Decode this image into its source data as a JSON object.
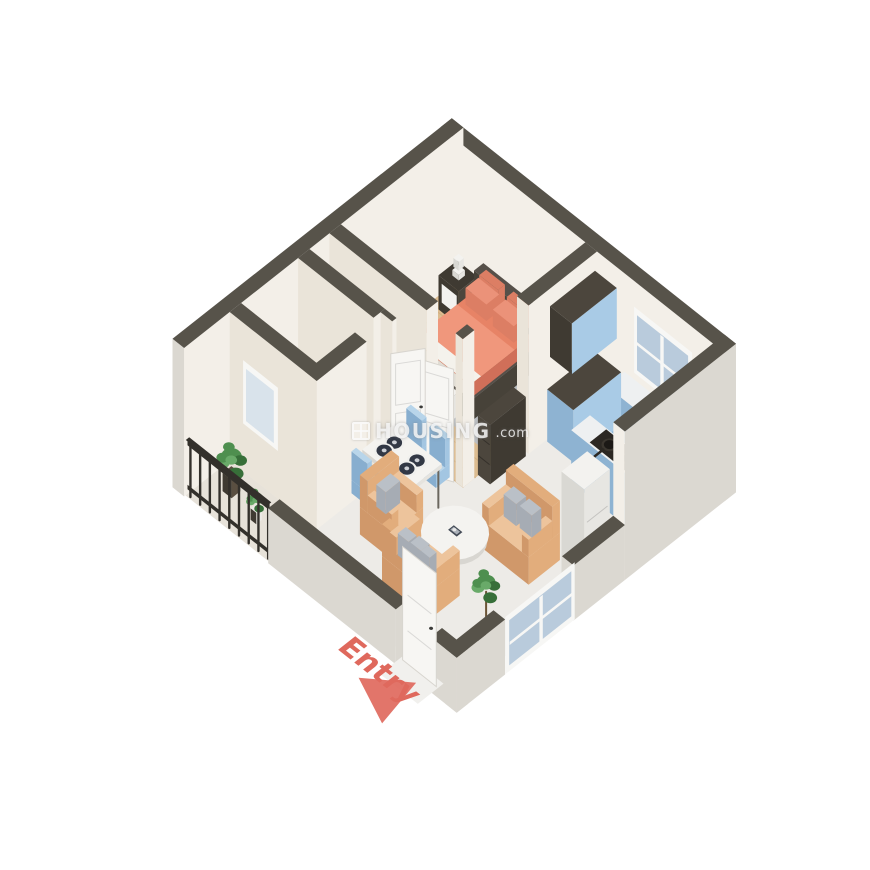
{
  "watermark": {
    "brand": "HOUSING",
    "tld": ".com",
    "logo": "housing-grid-logo",
    "opacity": 0.82
  },
  "labels": {
    "entry": "Entry"
  },
  "scene": {
    "type": "isometric-3d-floorplan",
    "rooms": [
      "bedroom",
      "bathroom",
      "balcony",
      "kitchen",
      "living-dining"
    ],
    "furniture": [
      "double-bed",
      "nightstand",
      "table-lamp",
      "bed-bench",
      "tv-console",
      "wardrobe-dresser",
      "toilet",
      "washbasin",
      "dining-table",
      "dining-chairs",
      "dinner-plates",
      "armchair",
      "loveseat",
      "sofa",
      "coffee-table",
      "kitchen-counter",
      "kitchen-island",
      "stove-with-pots",
      "tall-cabinet",
      "refrigerator",
      "windows",
      "doors",
      "balcony-railing",
      "potted-plants",
      "entry-arrow"
    ]
  },
  "palette": {
    "wallTop": "#57534a",
    "wallIn": "#f3efe8",
    "wallIn2": "#eae4d9",
    "wallExt": "#dbd8d1",
    "wood": "#dcbc90",
    "woodLine": "#c4a274",
    "marble": "#edebe7",
    "tile": "#a9acb1",
    "tileLine": "#95989f",
    "balcony": "#e7e2d9",
    "rug": "#babdc0",
    "bedFrame": "#565049",
    "bedFrameDark": "#474239",
    "bedOrange": "#e78366",
    "bedOrangeDark": "#d06f59",
    "bedOrangeLight": "#f0977c",
    "pillowOrange": "#eb9279",
    "pillowOrangeDark": "#dc7e64",
    "sheet": "#f4f2ec",
    "sheetDark": "#e1ddd4",
    "white": "#f3f2ef",
    "whiteShade": "#e7e6e2",
    "whiteShade2": "#d9d8d3",
    "darkWood": "#4c463d",
    "darkWood2": "#3f3a32",
    "black1": "#36322b",
    "black2": "#2a2621",
    "doorWhite": "#f7f6f3",
    "doorEdge": "#d8d5cf",
    "cabBlue": "#a9cbe6",
    "cabBlueDark": "#8eb3d2",
    "counter": "#eef0f1",
    "stove": "#2c2823",
    "pot": "#3b362f",
    "table": "#f4f3f0",
    "tableSide": "#e5e3de",
    "tableSide2": "#d8d6d1",
    "chairBlue": "#a3c6e2",
    "chairBlueDark": "#87aecf",
    "chairBlueTop": "#b8d5ea",
    "sofa": "#e2ad7c",
    "sofaDark": "#d0986a",
    "sofaLight": "#edc49c",
    "pillowGray": "#bac0c7",
    "pillowGrayDark": "#a6acb4",
    "rail": "#33302b",
    "green1": "#4e8f4f",
    "green2": "#376f39",
    "green3": "#69aa69",
    "glass": "#b9cbdc",
    "glassFrost": "#d9e3eb",
    "frame": "#f7f7f5",
    "entryRed": "#df695d",
    "threshold": "#f1f0ed",
    "legDark": "#6b675f",
    "potW": "#eceae6",
    "potD": "#5a4f41",
    "plateDark": "#323845",
    "plateRim": "#f0f0ee"
  }
}
